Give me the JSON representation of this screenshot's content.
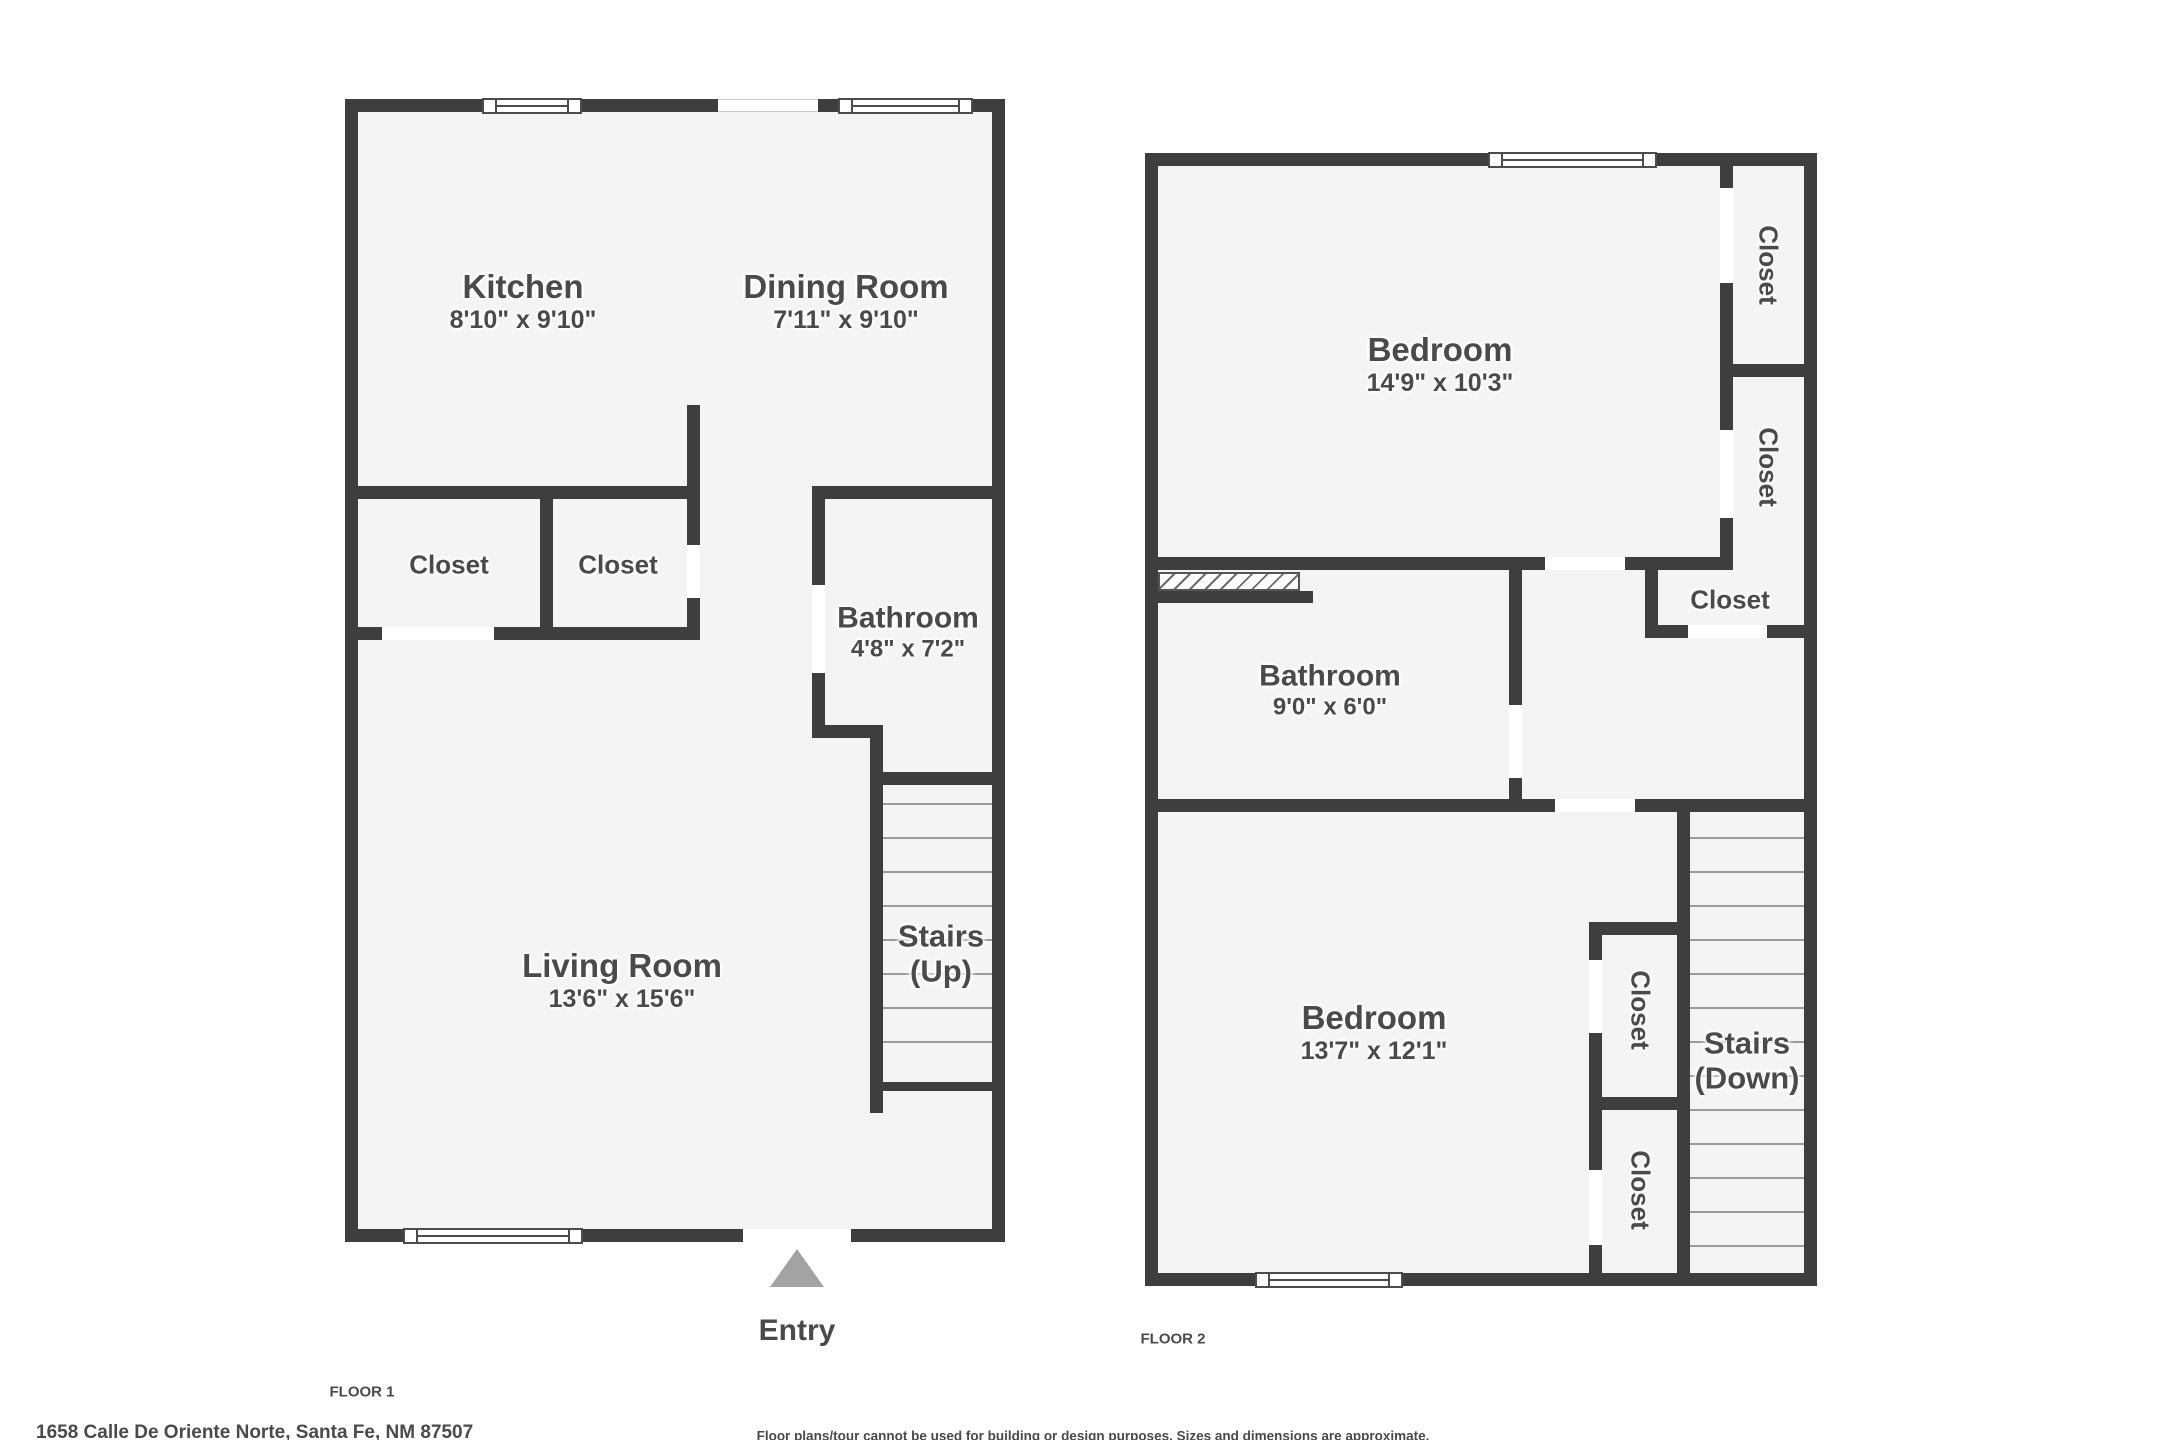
{
  "floor1": {
    "label": "FLOOR 1",
    "rooms": {
      "kitchen": {
        "name": "Kitchen",
        "dims": "8'10\" x 9'10\""
      },
      "dining_room": {
        "name": "Dining Room",
        "dims": "7'11\" x 9'10\""
      },
      "closet_a": {
        "name": "Closet"
      },
      "closet_b": {
        "name": "Closet"
      },
      "bathroom": {
        "name": "Bathroom",
        "dims": "4'8\" x 7'2\""
      },
      "living_room": {
        "name": "Living Room",
        "dims": "13'6\" x 15'6\""
      },
      "stairs": {
        "name": "Stairs",
        "direction": "(Up)"
      },
      "entry": {
        "name": "Entry"
      }
    }
  },
  "floor2": {
    "label": "FLOOR 2",
    "rooms": {
      "bedroom_top": {
        "name": "Bedroom",
        "dims": "14'9\" x 10'3\""
      },
      "closet_1": {
        "name": "Closet"
      },
      "closet_2": {
        "name": "Closet"
      },
      "closet_3": {
        "name": "Closet"
      },
      "bathroom": {
        "name": "Bathroom",
        "dims": "9'0\" x 6'0\""
      },
      "bedroom_bottom": {
        "name": "Bedroom",
        "dims": "13'7\" x 12'1\""
      },
      "closet_4": {
        "name": "Closet"
      },
      "closet_5": {
        "name": "Closet"
      },
      "stairs": {
        "name": "Stairs",
        "direction": "(Down)"
      }
    }
  },
  "footer": {
    "address": "1658 Calle De Oriente Norte, Santa Fe, NM 87507",
    "disclaimer": "Floor plans/tour cannot be used for building or design purposes. Sizes and dimensions are approximate."
  },
  "colors": {
    "wall": "#3e3e3e",
    "floor": "#f4f4f4",
    "text": "#4a4a4a",
    "tread": "#9b9b9b",
    "entry_arrow": "#a3a3a3"
  }
}
